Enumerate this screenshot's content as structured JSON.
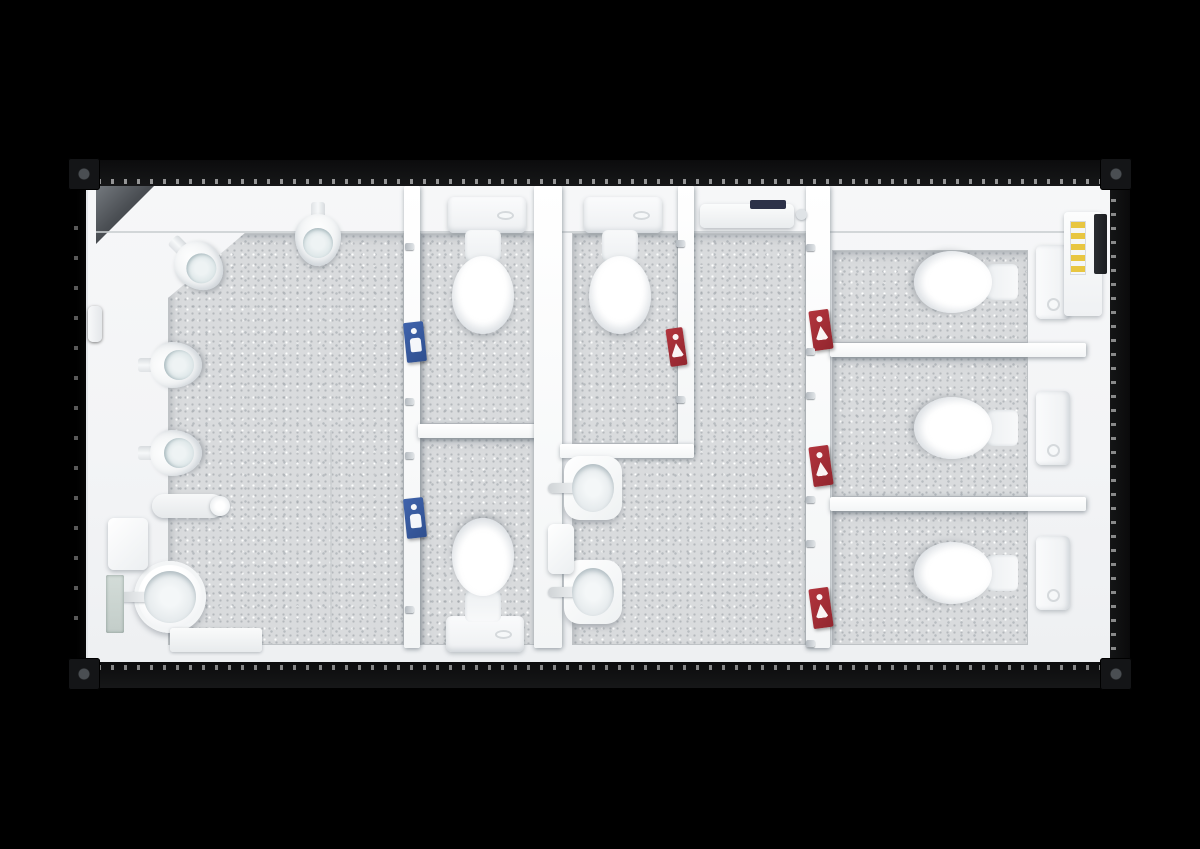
{
  "meta": {
    "description": "Top-down cutaway rendering of a sanitary container washroom unit, no visible text labels",
    "background": "#000000"
  },
  "palette": {
    "floor": "#d9dbdd",
    "wall": "#f7f8f9",
    "sign_blue": "#3f63ac",
    "sign_red": "#b2353e",
    "heater_accent": "#2c3148",
    "panel_yellow": "#e8c641",
    "exterior": "#000000"
  },
  "scene": {
    "structure": [
      {
        "type": "corr-side-faint",
        "name": "corrugated-left-side",
        "x": 72,
        "y": 200,
        "w": 14,
        "h": 440
      },
      {
        "type": "body",
        "name": "container-shell",
        "x": 88,
        "y": 184,
        "w": 1024,
        "h": 482
      },
      {
        "type": "floor",
        "name": "mens-room-floor",
        "x": 168,
        "y": 233,
        "w": 236,
        "h": 412,
        "clip": "polygon(77px 0px, 236px 0px, 236px 412px, 0px 412px, 0px 65px)"
      },
      {
        "type": "floor",
        "name": "mens-stall-1-floor",
        "x": 420,
        "y": 233,
        "w": 116,
        "h": 191
      },
      {
        "type": "floor",
        "name": "mens-stall-2-floor",
        "x": 420,
        "y": 437,
        "w": 116,
        "h": 208
      },
      {
        "type": "floor",
        "name": "womens-stall-floor",
        "x": 572,
        "y": 233,
        "w": 106,
        "h": 211
      },
      {
        "type": "floor",
        "name": "womens-room-floor",
        "x": 572,
        "y": 233,
        "w": 234,
        "h": 412,
        "clip": "polygon(122px 0px, 234px 0px, 234px 412px, 0px 412px, 0px 224px, 122px 224px)"
      },
      {
        "type": "floor",
        "name": "right-stall-1-floor",
        "x": 832,
        "y": 250,
        "w": 196,
        "h": 93
      },
      {
        "type": "floor",
        "name": "right-stall-2-floor",
        "x": 832,
        "y": 356,
        "w": 196,
        "h": 141
      },
      {
        "type": "floor",
        "name": "right-stall-3-floor",
        "x": 832,
        "y": 510,
        "w": 196,
        "h": 135
      },
      {
        "type": "chamfer",
        "name": "corner-chamfer",
        "x": 96,
        "y": 186,
        "w": 58,
        "h": 58
      },
      {
        "type": "seam",
        "name": "top-wall-seam",
        "x": 96,
        "y": 231,
        "w": 1008,
        "h": 2
      },
      {
        "type": "seam",
        "name": "mens-floor-seam",
        "x": 330,
        "y": 430,
        "w": 2,
        "h": 215
      },
      {
        "type": "wall",
        "name": "mens-stall-door-wall",
        "x": 404,
        "y": 186,
        "w": 16,
        "h": 462
      },
      {
        "type": "wall",
        "name": "mens-stall-partition",
        "x": 418,
        "y": 424,
        "w": 120,
        "h": 14
      },
      {
        "type": "wall",
        "name": "center-divider-wall",
        "x": 534,
        "y": 186,
        "w": 28,
        "h": 462
      },
      {
        "type": "wall",
        "name": "womens-stall-side-wall",
        "x": 678,
        "y": 186,
        "w": 16,
        "h": 264
      },
      {
        "type": "wall",
        "name": "womens-stall-front-wall",
        "x": 560,
        "y": 444,
        "w": 134,
        "h": 14
      },
      {
        "type": "wall",
        "name": "right-stall-door-wall",
        "x": 806,
        "y": 186,
        "w": 24,
        "h": 462
      },
      {
        "type": "wall",
        "name": "right-stall-partition-1",
        "x": 830,
        "y": 343,
        "w": 256,
        "h": 14
      },
      {
        "type": "wall",
        "name": "right-stall-partition-2",
        "x": 830,
        "y": 497,
        "w": 256,
        "h": 14
      },
      {
        "type": "corr-top",
        "name": "corrugated-top-edge",
        "x": 88,
        "y": 160,
        "w": 1024,
        "h": 26
      },
      {
        "type": "corr-bottom",
        "name": "corrugated-bottom-edge",
        "x": 88,
        "y": 662,
        "w": 1024,
        "h": 26
      },
      {
        "type": "corr-side",
        "name": "corrugated-right-side",
        "x": 1110,
        "y": 188,
        "w": 20,
        "h": 472
      },
      {
        "type": "casting",
        "name": "corner-casting-top-left",
        "x": 68,
        "y": 158,
        "w": 32,
        "h": 32
      },
      {
        "type": "casting",
        "name": "corner-casting-top-right",
        "x": 1100,
        "y": 158,
        "w": 32,
        "h": 32
      },
      {
        "type": "casting",
        "name": "corner-casting-bottom-left",
        "x": 68,
        "y": 658,
        "w": 32,
        "h": 32
      },
      {
        "type": "casting",
        "name": "corner-casting-bottom-right",
        "x": 1100,
        "y": 658,
        "w": 32,
        "h": 32
      }
    ],
    "fixtures": [
      {
        "type": "urinal",
        "name": "urinal-corner",
        "x": 172,
        "y": 230,
        "rot": -45
      },
      {
        "type": "urinal",
        "name": "urinal-top-wall",
        "x": 295,
        "y": 202,
        "rot": 0
      },
      {
        "type": "urinal",
        "name": "urinal-left-wall-1",
        "x": 147,
        "y": 333,
        "rot": -90
      },
      {
        "type": "urinal",
        "name": "urinal-left-wall-2",
        "x": 147,
        "y": 421,
        "rot": -90
      },
      {
        "type": "cistern-h",
        "name": "cistern-mens-stall-1",
        "x": 448,
        "y": 197
      },
      {
        "type": "toilet",
        "name": "toilet-mens-stall-1",
        "x": 451,
        "y": 230,
        "rot": 0
      },
      {
        "type": "cistern-h",
        "name": "cistern-mens-stall-2",
        "x": 446,
        "y": 616
      },
      {
        "type": "toilet",
        "name": "toilet-mens-stall-2",
        "x": 451,
        "y": 518,
        "rot": 180
      },
      {
        "type": "cistern-h",
        "name": "cistern-womens-stall",
        "x": 584,
        "y": 197
      },
      {
        "type": "toilet",
        "name": "toilet-womens-stall",
        "x": 588,
        "y": 230,
        "rot": 0
      },
      {
        "type": "cistern-v",
        "name": "cistern-right-stall-1",
        "x": 1036,
        "y": 245
      },
      {
        "type": "toilet",
        "name": "toilet-right-stall-1",
        "x": 934,
        "y": 230,
        "rot": 90
      },
      {
        "type": "cistern-v",
        "name": "cistern-right-stall-2",
        "x": 1036,
        "y": 391
      },
      {
        "type": "toilet",
        "name": "toilet-right-stall-2",
        "x": 934,
        "y": 376,
        "rot": 90
      },
      {
        "type": "cistern-v",
        "name": "cistern-right-stall-3",
        "x": 1036,
        "y": 536
      },
      {
        "type": "toilet",
        "name": "toilet-right-stall-3",
        "x": 934,
        "y": 521,
        "rot": 90
      },
      {
        "type": "basin-round",
        "name": "washbasin-mens",
        "x": 134,
        "y": 561
      },
      {
        "type": "basin-square",
        "name": "washbasin-womens-1",
        "x": 564,
        "y": 456
      },
      {
        "type": "basin-square",
        "name": "washbasin-womens-2",
        "x": 564,
        "y": 560
      },
      {
        "type": "heater",
        "name": "wall-heater",
        "x": 700,
        "y": 204
      },
      {
        "type": "panel",
        "name": "electrical-panel",
        "x": 1064,
        "y": 212,
        "w": 38,
        "h": 104
      },
      {
        "type": "slot",
        "name": "wall-vent-slot",
        "x": 1094,
        "y": 214,
        "w": 13,
        "h": 60
      },
      {
        "type": "dispenser",
        "name": "soap-dispenser-mens",
        "x": 108,
        "y": 518,
        "w": 40,
        "h": 52
      },
      {
        "type": "dispenser",
        "name": "soap-dispenser-womens",
        "x": 548,
        "y": 524,
        "w": 26,
        "h": 50
      },
      {
        "type": "mirror",
        "name": "mirror-mens",
        "x": 106,
        "y": 575,
        "w": 18,
        "h": 58
      },
      {
        "type": "shelf",
        "name": "floor-shelf-mens",
        "x": 170,
        "y": 628,
        "w": 92,
        "h": 24
      },
      {
        "type": "faucet-arm",
        "name": "utility-faucet-mens",
        "x": 152,
        "y": 494,
        "w": 72,
        "h": 24
      },
      {
        "type": "handle",
        "name": "entrance-door-handle",
        "x": 88,
        "y": 306,
        "w": 14,
        "h": 36
      }
    ],
    "signs": [
      {
        "type": "sign-blue",
        "name": "mens-stall-1-door-sign",
        "x": 405,
        "y": 322,
        "rot": -6
      },
      {
        "type": "sign-blue",
        "name": "mens-stall-2-door-sign",
        "x": 405,
        "y": 498,
        "rot": -6
      },
      {
        "type": "sign-red",
        "name": "womens-stall-door-sign",
        "x": 668,
        "y": 328,
        "w": 17,
        "h": 38,
        "rot": -8
      },
      {
        "type": "sign-red",
        "name": "right-stall-1-door-sign",
        "x": 811,
        "y": 310,
        "rot": -8
      },
      {
        "type": "sign-red",
        "name": "right-stall-2-door-sign",
        "x": 811,
        "y": 446,
        "rot": -8
      },
      {
        "type": "sign-red",
        "name": "right-stall-3-door-sign",
        "x": 811,
        "y": 588,
        "rot": -8
      }
    ],
    "hinges": [
      {
        "x": 405,
        "y": 243
      },
      {
        "x": 405,
        "y": 398
      },
      {
        "x": 405,
        "y": 452
      },
      {
        "x": 405,
        "y": 606
      },
      {
        "x": 676,
        "y": 240
      },
      {
        "x": 676,
        "y": 396
      },
      {
        "x": 806,
        "y": 244
      },
      {
        "x": 806,
        "y": 348
      },
      {
        "x": 806,
        "y": 392
      },
      {
        "x": 806,
        "y": 496
      },
      {
        "x": 806,
        "y": 540
      },
      {
        "x": 806,
        "y": 640
      }
    ]
  }
}
